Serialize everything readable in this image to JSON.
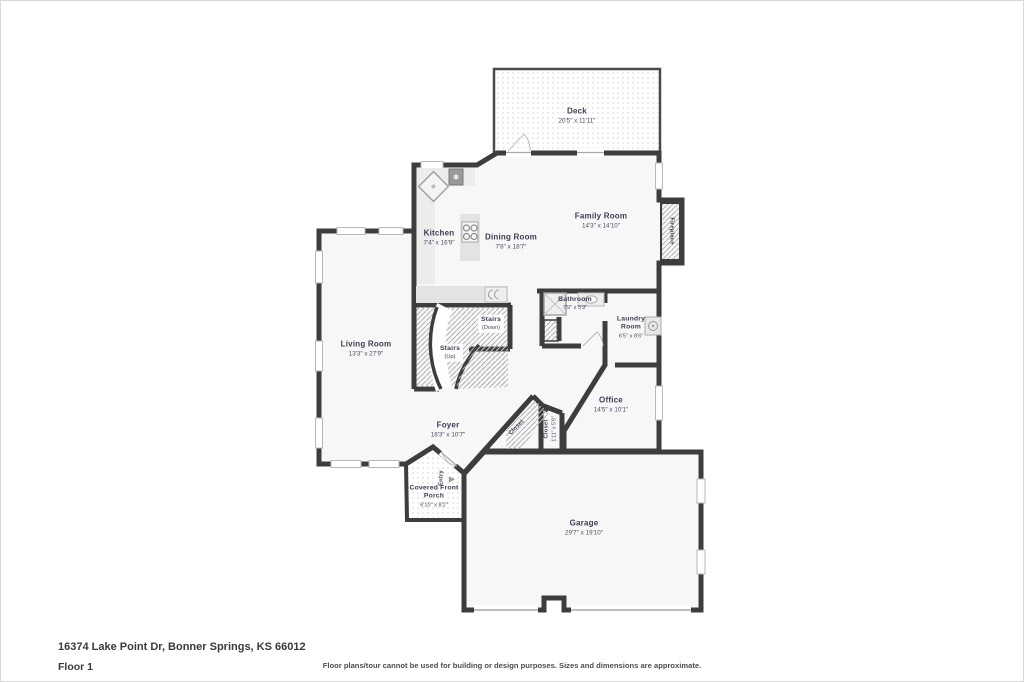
{
  "address": "16374 Lake Point Dr, Bonner Springs, KS 66012",
  "floor_label": "Floor 1",
  "disclaimer": "Floor plans/tour cannot be used for building or design purposes. Sizes and dimensions are approximate.",
  "rooms": {
    "deck": {
      "name": "Deck",
      "dims": "20'5\" x 11'11\""
    },
    "family_room": {
      "name": "Family Room",
      "dims": "14'3\" x 14'10\""
    },
    "kitchen": {
      "name": "Kitchen",
      "dims": "7'4\" x 16'9\""
    },
    "dining_room": {
      "name": "Dining Room",
      "dims": "7'8\" x 18'7\""
    },
    "living_room": {
      "name": "Living Room",
      "dims": "13'3\" x 27'9\""
    },
    "stairs_up": {
      "name": "Stairs",
      "dims": "(Up)"
    },
    "stairs_down": {
      "name": "Stairs",
      "dims": "(Down)"
    },
    "bathroom": {
      "name": "Bathroom",
      "dims": "7'9\" x 5'9\""
    },
    "laundry": {
      "name": "Laundry Room",
      "dims": "6'5\" x 8'6\""
    },
    "office": {
      "name": "Office",
      "dims": "14'5\" x 10'1\""
    },
    "foyer": {
      "name": "Foyer",
      "dims": "18'3\" x 10'7\""
    },
    "closet_hall": {
      "name": "Closet",
      "dims": ""
    },
    "closet_entry": {
      "name": "Closet",
      "dims": "1'11\" x 5'9\""
    },
    "porch": {
      "name": "Covered Front Porch",
      "dims": "6'10\" x 8'2\""
    },
    "garage": {
      "name": "Garage",
      "dims": "29'7\" x 19'10\""
    },
    "fireplace": {
      "name": "Fireplace",
      "dims": ""
    },
    "entry": {
      "name": "Entry",
      "dims": ""
    }
  },
  "colors": {
    "wall": "#3d3d3d",
    "room_fill": "#f7f7f7",
    "hatch": "#b5b5b5",
    "dots": "#cfcfcf",
    "text": "#3d3d52"
  }
}
